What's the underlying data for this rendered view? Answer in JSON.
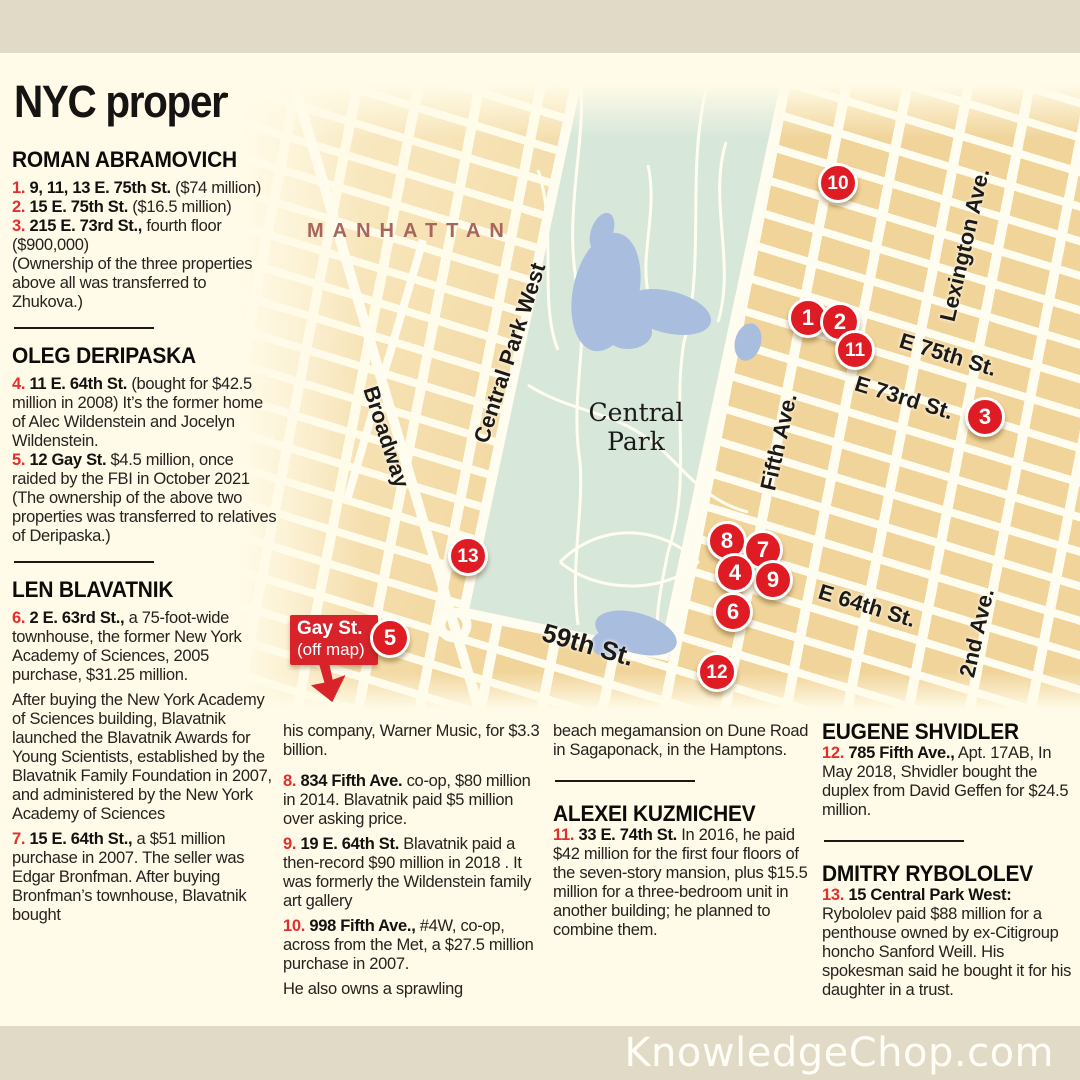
{
  "title": "NYC properties bought by Russian oligarchs",
  "watermark": "KnowledgeChop.com",
  "colors": {
    "background": "#fffbe8",
    "frame_bar": "#e0dac6",
    "block_tan": "#f1d49a",
    "street_white": "#fffdf0",
    "park_green": "#d7e7da",
    "lake_blue": "#a9bddf",
    "marker_red": "#df1b23",
    "number_red": "#e52e2b",
    "region_brown": "#a8655c"
  },
  "map": {
    "region": "MANHATTAN",
    "park_line1": "Central",
    "park_line2": "Park",
    "streets": {
      "cpw": "Central Park West",
      "broadway": "Broadway",
      "fifth": "Fifth Ave.",
      "lex": "Lexington Ave.",
      "second": "2nd Ave.",
      "e75": "E 75th St.",
      "e73": "E 73rd St.",
      "e64": "E 64th St.",
      "s59": "59th St."
    },
    "callout": {
      "line1": "Gay St.",
      "line2": "(off map)"
    },
    "markers": [
      {
        "label": "10",
        "x": 838,
        "y": 183
      },
      {
        "label": "1",
        "x": 808,
        "y": 318
      },
      {
        "label": "2",
        "x": 840,
        "y": 322
      },
      {
        "label": "11",
        "x": 855,
        "y": 350
      },
      {
        "label": "3",
        "x": 985,
        "y": 417
      },
      {
        "label": "13",
        "x": 468,
        "y": 556
      },
      {
        "label": "8",
        "x": 727,
        "y": 541
      },
      {
        "label": "7",
        "x": 763,
        "y": 550
      },
      {
        "label": "9",
        "x": 773,
        "y": 580
      },
      {
        "label": "4",
        "x": 735,
        "y": 573
      },
      {
        "label": "6",
        "x": 733,
        "y": 612
      },
      {
        "label": "12",
        "x": 717,
        "y": 672
      },
      {
        "label": "5",
        "x": 390,
        "y": 638
      }
    ]
  },
  "col1": {
    "h1": "ROMAN ABRAMOVICH",
    "i1": {
      "n": "1.",
      "a": "9, 11, 13 E. 75th St.",
      "r": " ($74 million)"
    },
    "i2": {
      "n": "2.",
      "a": "15 E. 75th St.",
      "r": " ($16.5 million)"
    },
    "i3": {
      "n": "3.",
      "a": "215 E. 73rd St.,",
      "r": " fourth floor ($900,000)"
    },
    "note1": "(Ownership of the three properties above all was transferred to Zhukova.)",
    "h2": "OLEG DERIPASKA",
    "i4": {
      "n": "4.",
      "a": "11 E. 64th St.",
      "r": " (bought for $42.5 million in 2008) It’s the former home of Alec Wildenstein and Jocelyn Wildenstein."
    },
    "i5": {
      "n": "5.",
      "a": "12 Gay St.",
      "r": " $4.5 million, once raided by the FBI in October 2021"
    },
    "note2": "(The ownership of the above two properties was transferred to relatives of Deripaska.)",
    "h3": "LEN BLAVATNIK",
    "i6": {
      "n": "6.",
      "a": "2 E. 63rd St.,",
      "r": " a 75-foot-wide townhouse, the former New York Academy of Sciences, 2005 purchase, $31.25 million."
    },
    "p1": "After buying the New York Academy of Sciences building, Blavatnik launched the Blavatnik Awards for Young Scientists, established by the Blavatnik Family Foundation in 2007, and administered by the New York Academy of Sciences",
    "i7": {
      "n": "7.",
      "a": "15 E. 64th St.,",
      "r": " a $51 million purchase in 2007. The seller was Edgar Bronfman. After buying Bronfman’s townhouse, Blavatnik bought"
    }
  },
  "col2": {
    "p1": "his company, Warner Music, for $3.3 billion.",
    "i8": {
      "n": "8.",
      "a": "834 Fifth Ave.",
      "r": " co-op, $80 million in 2014. Blavatnik paid $5 million over asking price."
    },
    "i9": {
      "n": "9.",
      "a": "19 E. 64th St.",
      "r": " Blavatnik paid a then-record $90 million in 2018 . It was formerly the Wildenstein family art gallery"
    },
    "i10": {
      "n": "10.",
      "a": "998 Fifth Ave.,",
      "r": " #4W, co-op, across from the Met, a $27.5 million purchase in 2007."
    },
    "p2": "He also owns a sprawling"
  },
  "col3": {
    "p1": "beach megamansion on Dune Road in Sagaponack, in the Hamptons.",
    "h": "ALEXEI KUZMICHEV",
    "i11": {
      "n": "11.",
      "a": "33 E. 74th St.",
      "r": " In 2016, he paid $42 million for the first four floors of the seven-story mansion, plus $15.5 million for a three-bedroom unit in another building; he planned to combine them."
    }
  },
  "col4": {
    "h1": "EUGENE SHVIDLER",
    "i12": {
      "n": "12.",
      "a": "785 Fifth Ave.,",
      "r": " Apt. 17AB, In May 2018, Shvidler bought the duplex from David Geffen for $24.5 million."
    },
    "h2": "DMITRY RYBOLOLEV",
    "i13": {
      "n": "13.",
      "a": "15 Central Park West:",
      "r": " Rybololev paid $88 million for a penthouse owned by ex-Citigroup honcho Sanford Weill. His spokesman said he bought it for his daughter in a trust."
    }
  }
}
